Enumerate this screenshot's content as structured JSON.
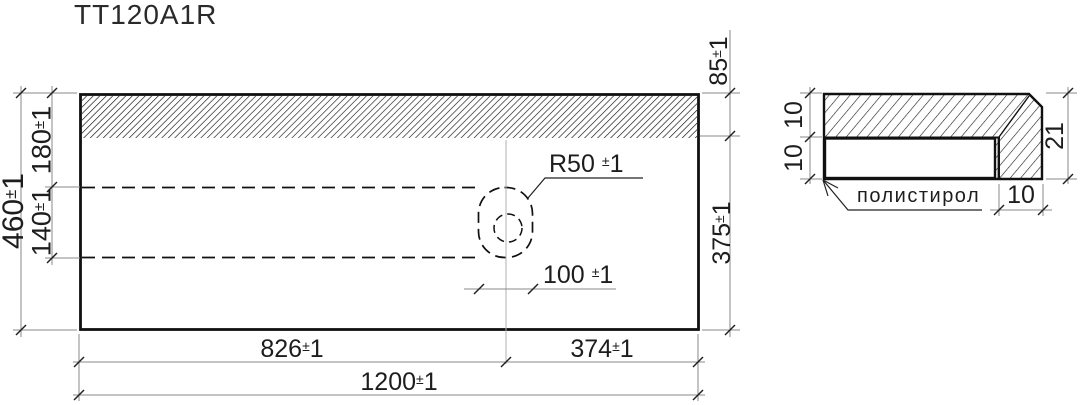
{
  "title": "TT120A1R",
  "main_view": {
    "dims": {
      "height_total": {
        "value": "460",
        "pm": "±",
        "tol": "1"
      },
      "height_top": {
        "value": "180",
        "pm": "±",
        "tol": "1"
      },
      "height_middle": {
        "value": "140",
        "pm": "±",
        "tol": "1"
      },
      "backsplash": {
        "value": "85",
        "pm": "±",
        "tol": "1"
      },
      "depth": {
        "value": "375",
        "pm": "±",
        "tol": "1"
      },
      "radius": {
        "value": "R50",
        "pm": "±",
        "tol": "1"
      },
      "hole_offset": {
        "value": "100",
        "pm": "±",
        "tol": "1"
      },
      "width_left": {
        "value": "826",
        "pm": "±",
        "tol": "1"
      },
      "width_right": {
        "value": "374",
        "pm": "±",
        "tol": "1"
      },
      "width_total": {
        "value": "1200",
        "pm": "±",
        "tol": "1"
      }
    }
  },
  "section_view": {
    "dims": {
      "top_layer_thickness": {
        "value": "10"
      },
      "bottom_layer_thickness": {
        "value": "10"
      },
      "edge_height": {
        "value": "21"
      },
      "edge_width": {
        "value": "10"
      }
    },
    "material_label": {
      "value": "полистирол"
    }
  },
  "colors": {
    "line": "#111111",
    "dim_line": "#8a8a8a",
    "centerline": "#b0b0b0",
    "text": "#1d1d1d"
  }
}
